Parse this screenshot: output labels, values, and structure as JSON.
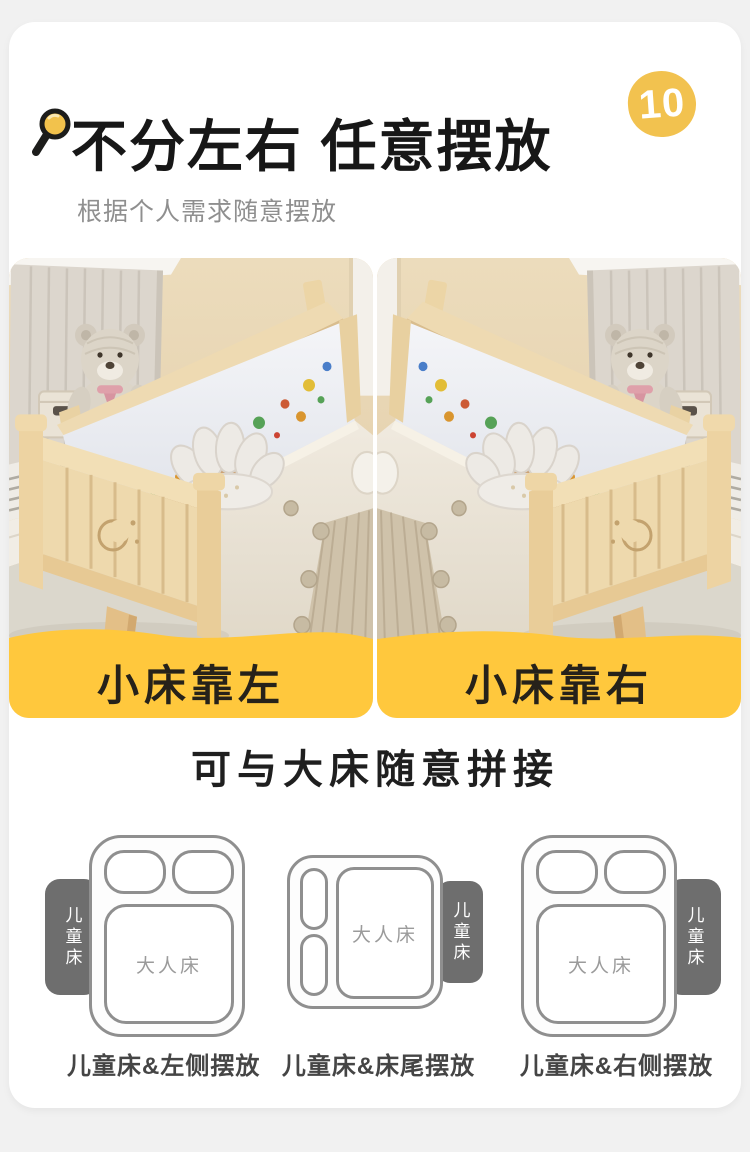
{
  "header": {
    "title": "不分左右 任意摆放",
    "subtitle": "根据个人需求随意摆放",
    "badge": "10"
  },
  "icons": {
    "title_icon": "magnifier-icon"
  },
  "gallery": {
    "left_label": "小床靠左",
    "right_label": "小床靠右"
  },
  "section": {
    "heading": "可与大床随意拼接"
  },
  "diagrams": {
    "adult_bed_label": "大人床",
    "child_bed_label": "儿童床",
    "items": [
      {
        "caption": "儿童床&左侧摆放",
        "child_position": "left"
      },
      {
        "caption": "儿童床&床尾摆放",
        "child_position": "foot"
      },
      {
        "caption": "儿童床&右侧摆放",
        "child_position": "right"
      }
    ]
  },
  "colors": {
    "accent_yellow": "#ffc83d",
    "badge_yellow": "#f2c24f",
    "title_black": "#171717",
    "subtitle_gray": "#8f8f8f",
    "diagram_outline": "#8f8f8f",
    "child_bed_fill": "#6e6e6e",
    "page_background": "#f1f1f1",
    "card_background": "#ffffff"
  }
}
